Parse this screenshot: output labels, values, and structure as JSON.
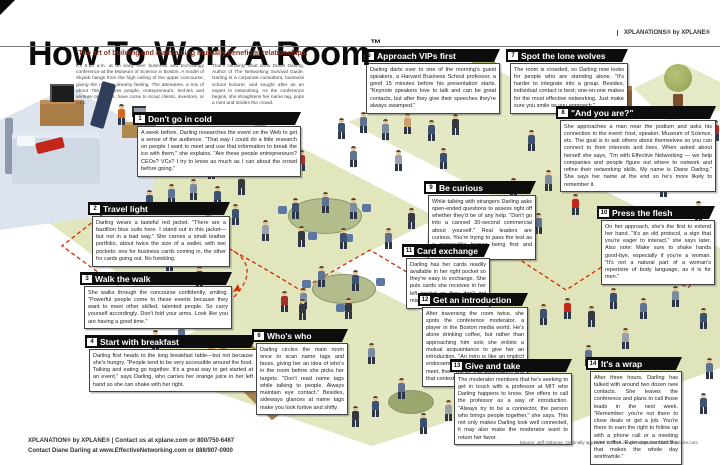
{
  "poster": {
    "title": "How To Work A Room",
    "trademark": "™",
    "subtitle": "The art of building and maintaining mutually beneficial relationships.",
    "brand": "XPLANATiONS® by XPLANE®",
    "intro_col1": "It's 6:50 a.m. at an early riser business and technology conference at the Museum of Science in Boston. A model of Skylab hangs from the high ceiling of the upper concourse, giving the room a dreamy feeling. The attendees, a mix of about 750 business people, entrepreneurs, techies and venture capitalists, have come to scout clients, investors, or jobs.",
    "intro_col2": "That's certainly what drew Diane Darling, Author of The Networking Survival Guide. Darling is a corporate consultant, business school lecturer, and sought after as an expert in networking. As the conference begins, she straightens her name tag, pops a mint and strides the crowd."
  },
  "callouts": [
    {
      "num": "1",
      "title": "Don't go in cold",
      "body": "A week before, Darling researches the event on the Web to get a sense of the audience. \"That way I could do a little research on people I want to meet and use that information to break the ice with them,\" she explains. \"Are these people entrepreneurs? CEOs? VCs? I try to know as much as I can about the crowd before going.\""
    },
    {
      "num": "2",
      "title": "Travel light",
      "body": "Darling wears a tasteful red jacket. \"There are a bazillion blue suits here. I stand out in this jacket—but not in a bad way.\" She carries a small leather portfolio, about twice the size of a wallet, with two pockets: one for business cards coming in, the other for cards going out. No fumbling."
    },
    {
      "num": "3",
      "title": "Walk the walk",
      "body": "She walks through the concourse confidently, smiling. \"Powerful people come to these events because they want to meet other skilled, talented people. So carry yourself accordingly. Don't fold your arms. Look like you are having a good time.\""
    },
    {
      "num": "4",
      "title": "Start with breakfast",
      "body": "Darling first heads to the long breakfast table—but not because she's hungry. \"People tend to be very accessible around the food. Talking and eating go together. It's a great way to get started at an event,\" says Darling, who carries her orange juice in her left hand so she can shake with her right."
    },
    {
      "num": "5",
      "title": "Approach VIPs first",
      "body": "Darling darts over to one of the morning's guest speakers, a Harvard Business School professor, a good 15 minutes before his presentation starts. \"Keynote speakers love to talk and can be great contacts, but after they give their speeches they're always swamped.\""
    },
    {
      "num": "6",
      "title": "Who's who",
      "body": "Darling circles the main room once to scan name tags and faces, giving her an idea of who's in the room before she picks her targets. \"Don't read name tags while talking to people. Always maintain eye contact.\" Besides, sideways glances at name tags make you look furtive and shifty."
    },
    {
      "num": "7",
      "title": "Spot the lone wolves",
      "body": "The room is crowded, so Darling now looks for people who are standing alone. \"It's harder to integrate into a group. Besides, individual contact is best; one-on-one makes for the most effective networking. Just make sure you smile as you approach.\""
    },
    {
      "num": "8",
      "title": "\"And you are?\"",
      "body": "She approaches a man near the podium and asks his connection to the event: host, speaker, Museum of Science, etc. The goal is to ask others about themselves so you can connect to their interests and lives. When asked about herself she says, \"I'm with Effective Networking — we help companies and people figure out where to network and refine their networking skills. My name is Diane Darling.\" She says her name at the end so he's more likely to remember it."
    },
    {
      "num": "9",
      "title": "Be curious",
      "body": "While talking with strangers Darling asks open-ended questions to assess right off whether they'd be of any help. \"Don't go into a canned 30-second commercial about yourself.\" Real leaders are curious. You're trying to pass the test as a personable human being first and foremost."
    },
    {
      "num": "10",
      "title": "Press the flesh",
      "body": "On her approach, she's the first to extend her hand. \"It's an old protocol, a sign that you're eager to interact,\" she says later. Also note: Make sure to shake hands good-bye, especially if you're a woman. \"It's not a natural part of a woman's repertoire of body language, as it is for men.\""
    },
    {
      "num": "11",
      "title": "Card exchange",
      "body": "Darling has her cards readily available in her right pocket so they're easy to exchange. She puts cards she receives in her left pocket so they don't get mixed up."
    },
    {
      "num": "12",
      "title": "Get an introduction",
      "body": "After traversing the room twice, she spots the conference moderator, a player in the Boston media world. He's alone drinking coffee, but rather than approaching him solo she enlists a mutual acquaintance to give her an introduction. \"An intro is like an implicit endorsement, and the next time we meet, there will be that association, and that context.\""
    },
    {
      "num": "13",
      "title": "Give and take",
      "body": "The moderator mentions that he's seeking to get in touch with a professor at MIT who Darling happens to know. She offers to call the professor as a way of introduction. \"Always try to be a connector, the person who brings people together,\" she says. This not only makes Darling look well connected, it may also make the moderator want to return her favor."
    },
    {
      "num": "14",
      "title": "It's a wrap",
      "body": "After three hours, Darling has talked with around two dozen new contacts. She leaves the conference and plans to call those leads in the next week. \"Remember: you're not there to close deals or get a job. You're there to earn the right to follow up with a phone call or a meeting over coffee. Even one contact like that makes the whole day worthwhile.\""
    }
  ],
  "footer": {
    "left_line1": "XPLANATION® by XPLANE® | Contact us at xplane.com or 800/750-6467",
    "left_line2": "Contact Diane Darling at www.EffectiveNetworking.com or 888/907-0900",
    "right_credit": "Source: Jeff Osborne. Originally appeared in MBA Jungle Magazine. ©2002 xplane.com"
  },
  "colors": {
    "floor_green": "#e2e6bd",
    "accent_red": "#cc2200",
    "callout_header_bg": "#0d0d0d",
    "subtitle_maroon": "#8a2f1f",
    "darling_jacket": "#c2271c"
  }
}
